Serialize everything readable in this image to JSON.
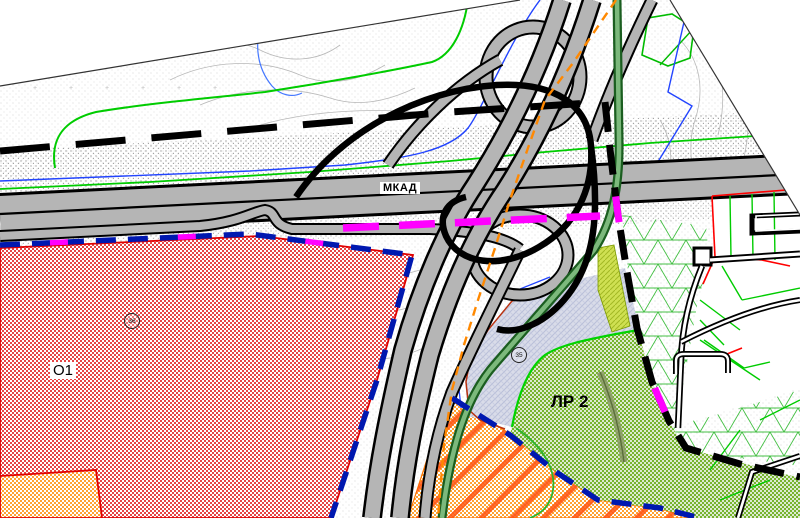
{
  "map": {
    "highway_label": "МКАД",
    "zone_o1_label": "О1",
    "zone_lr2_label": "ЛР 2",
    "marker_o1": "36",
    "marker_lr2": "35",
    "colors": {
      "zone_red": "#e64545",
      "zone_orange": "#ffa233",
      "zone_green": "#8cc63f",
      "zone_greyblue": "#d9dce9",
      "zone_chartreuse": "#cfe052",
      "boundary_navy": "#0018b0",
      "boundary_magenta": "#ff00ff",
      "planning_line_orange": "#ff8800",
      "road_fill": "#b5b5b5",
      "road_green": "#1b5e20",
      "parcel_green": "#00cc00",
      "water_blue": "#2244ff"
    }
  }
}
